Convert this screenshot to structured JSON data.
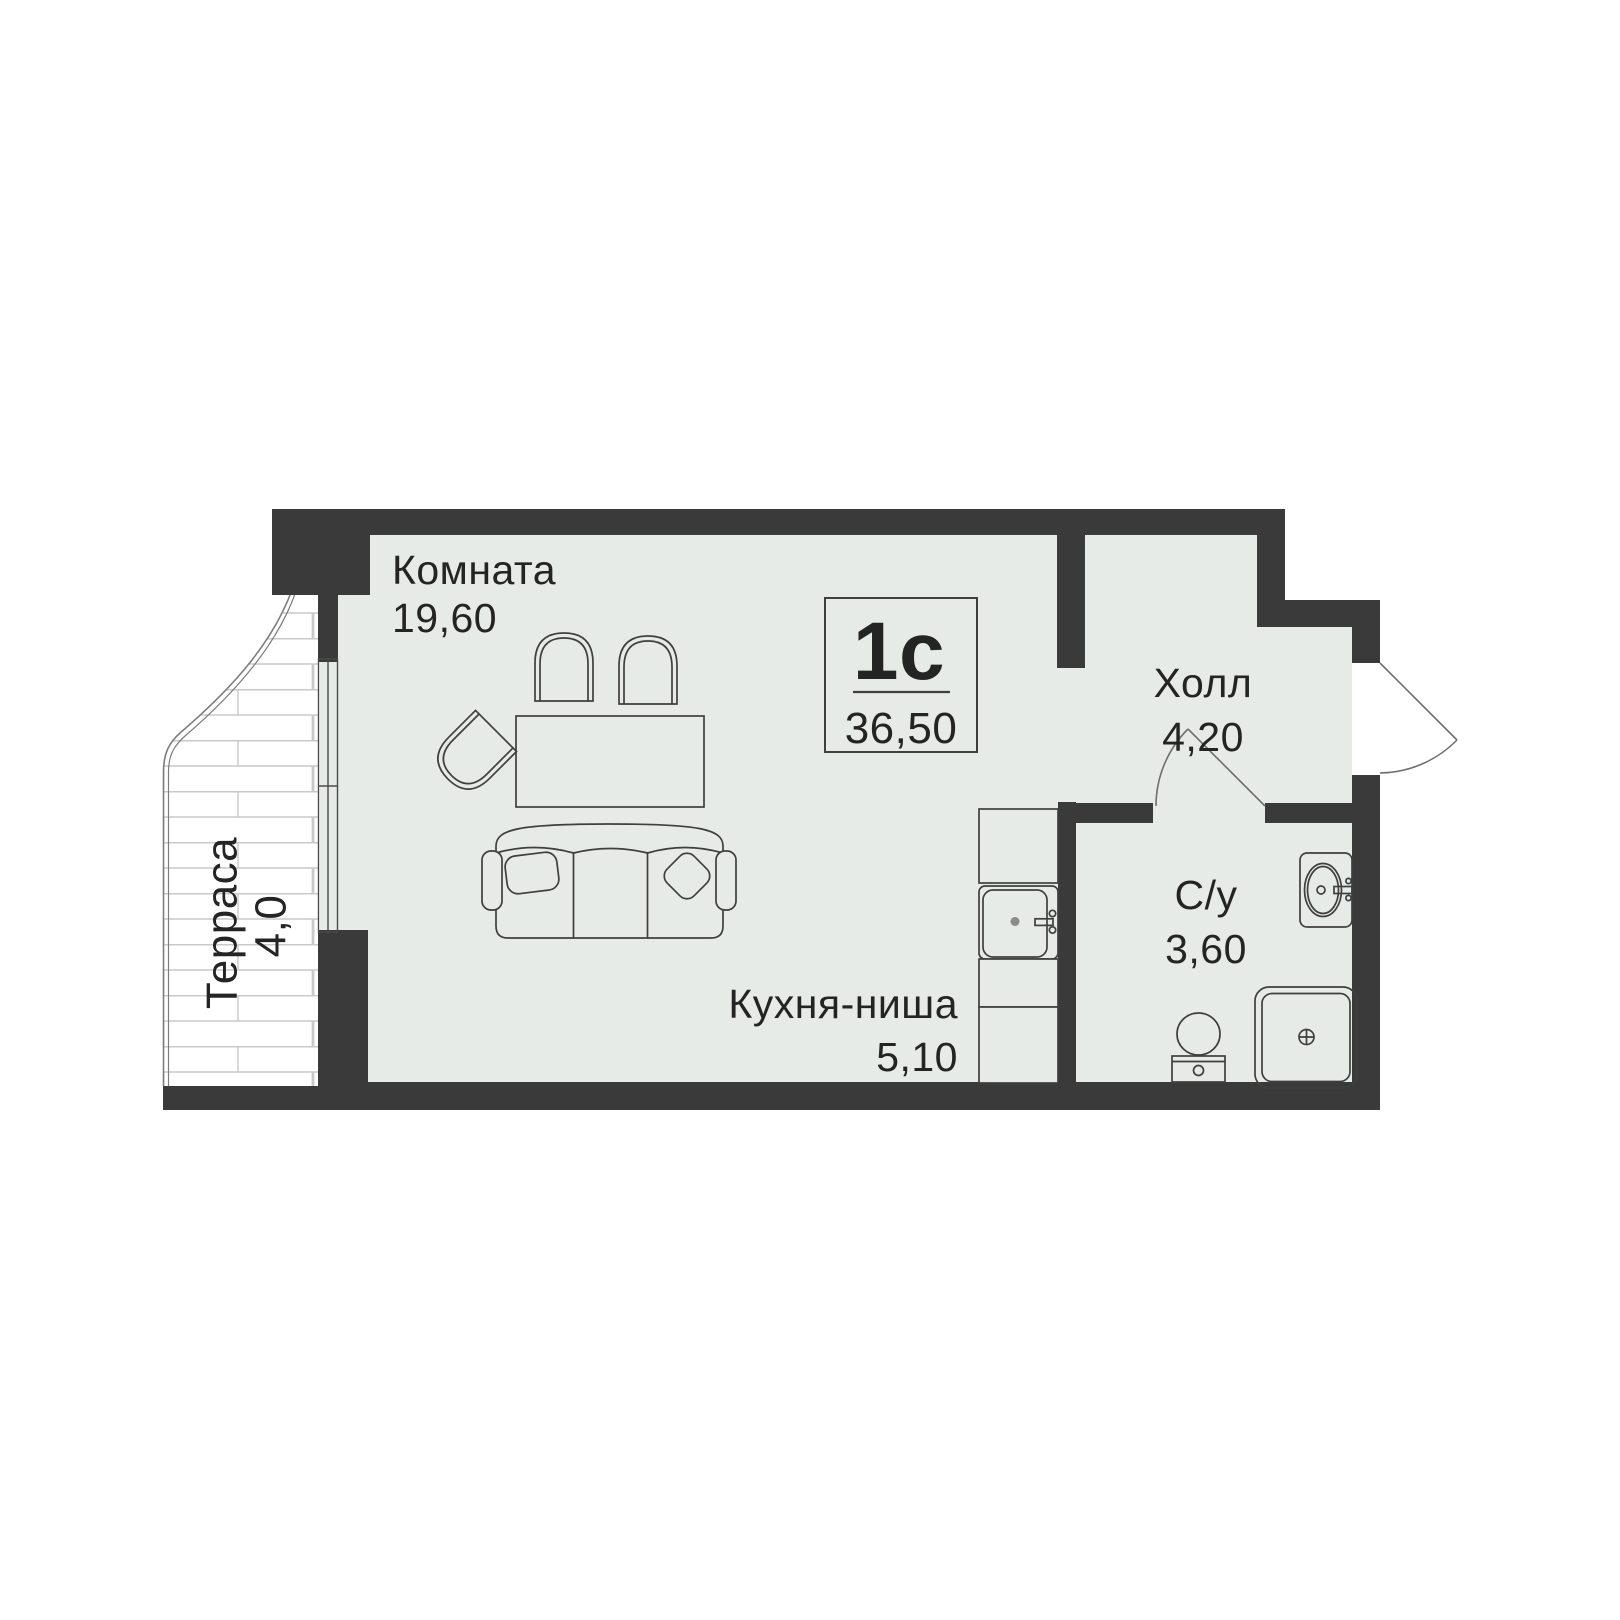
{
  "plan_title": "Планировка квартиры-студии",
  "badge": {
    "type": "1с",
    "area": "36,50"
  },
  "labels": {
    "room": {
      "name": "Комната",
      "area": "19,60"
    },
    "hall": {
      "name": "Холл",
      "area": "4,20"
    },
    "kitchen": {
      "name": "Кухня-ниша",
      "area": "5,10"
    },
    "bathroom": {
      "name": "С/у",
      "area": "3,60"
    },
    "terrace": {
      "name": "Терраса",
      "area": "4,0"
    }
  },
  "colors": {
    "wall": "#3a3a3a",
    "floor": "#e6ebe7",
    "outline": "#3f3f3f",
    "hatch": "#c9c9c9",
    "text": "#242424",
    "door_line": "#6f6f6f",
    "terrace_line": "#7d7d7d",
    "background": "#ffffff"
  },
  "icons": {
    "window": "window",
    "entrance_door": "door-swing",
    "bathroom_door": "door-swing",
    "sofa": "sofa",
    "table": "dining-table",
    "chairs": "chair",
    "kitchen_sink": "sink",
    "washbasin": "washbasin",
    "toilet": "toilet",
    "shower": "shower",
    "terrace_decking": "deck-hatch"
  }
}
